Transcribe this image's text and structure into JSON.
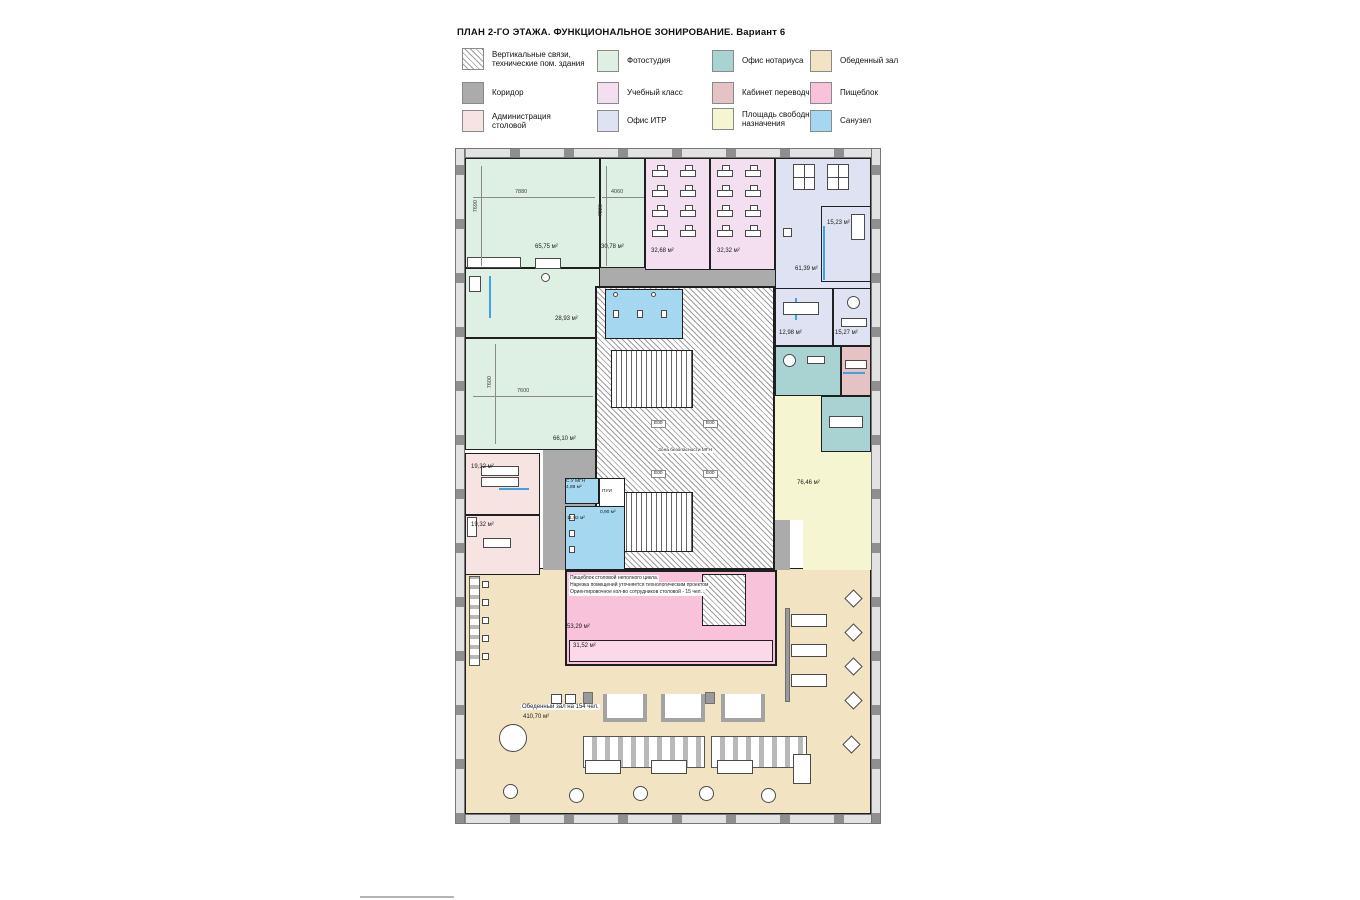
{
  "title": "ПЛАН 2-ГО ЭТАЖА. ФУНКЦИОНАЛЬНОЕ ЗОНИРОВАНИЕ. Вариант 6",
  "legend": {
    "items": [
      {
        "label": "Вертикальные связи,\nтехнические пом. здания",
        "color": "hatched-white"
      },
      {
        "label": "Коридор",
        "color": "#ababab"
      },
      {
        "label": "Администрация столовой",
        "color": "#f7e4e2"
      },
      {
        "label": "Фотостудия",
        "color": "#ddf0e3"
      },
      {
        "label": "Учебный класс",
        "color": "#f3dff0"
      },
      {
        "label": "Офис ИТР",
        "color": "#dfe2f3"
      },
      {
        "label": "Офис нотариуса",
        "color": "#a9d3d2"
      },
      {
        "label": "Кабинет переводчика",
        "color": "#e5c3c4"
      },
      {
        "label": "Площадь свободного назначения",
        "color": "#f5f5d2"
      },
      {
        "label": "Обеденный зал",
        "color": "#f2e4c2"
      },
      {
        "label": "Пищеблок",
        "color": "#f7c2da"
      },
      {
        "label": "Санузел",
        "color": "#a5d8f0"
      }
    ]
  },
  "plan": {
    "areas": {
      "photostudio_main": "65,75 м²",
      "photostudio_2": "30,78 м²",
      "classroom_1": "32,68 м²",
      "classroom_2": "32,32 м²",
      "itr_office": "61,39 м²",
      "itr_room_1": "15,23 м²",
      "itr_room_2": "12,98 м²",
      "itr_room_3": "15,27 м²",
      "photostudio_3": "28,93 м²",
      "photostudio_4": "66,10 м²",
      "admin_1": "19,32 м²",
      "admin_2": "19,32 м²",
      "free_zone": "76,46 м²",
      "su_mgn_name": "С.У МГН",
      "su_mgn": "4,88 м²",
      "pui": "ПУИ",
      "wc": "11,92 м²",
      "small_room": "0,90 м²",
      "kitchen": "53,29 м²",
      "kitchen_inner": "31,52 м²"
    },
    "dims": {
      "top_w": "7880",
      "top_h": "7690",
      "top2_w": "4060",
      "top2_h": "7220",
      "left_h": "7600",
      "left_w": "7600"
    },
    "core": {
      "safety_zone": "Зона безопасности МГН",
      "elevator": "Е00"
    },
    "kitchen_note": {
      "l1": "Пищеблок столовой неполного цикла.",
      "l2": "Нарезка помещений уточняется технологическим проектом",
      "l3": "Ориентировочное кол-во сотрудников столовой - 15 чел."
    },
    "dining": {
      "title": "Обеденный зал на 154 чел.",
      "area": "410,70 м²"
    }
  }
}
